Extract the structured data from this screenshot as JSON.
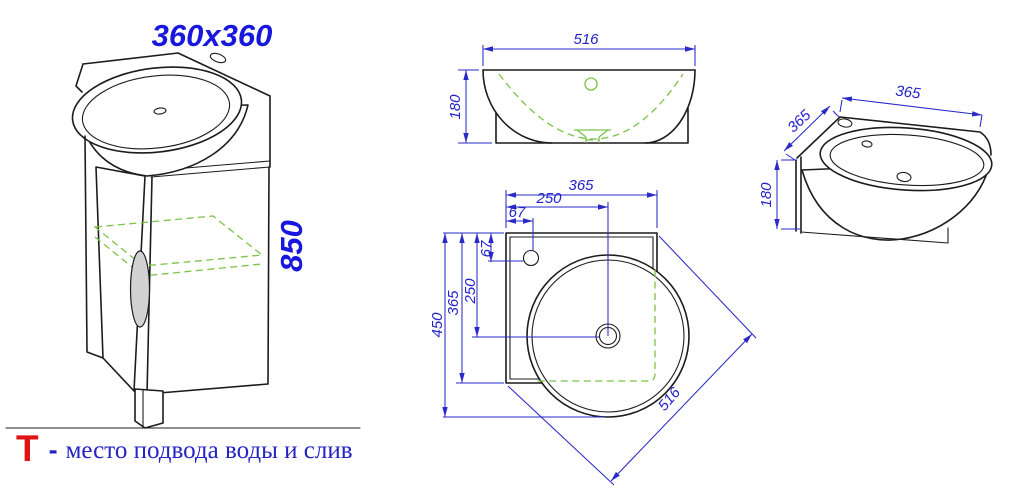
{
  "colors": {
    "dimension_blue": "#2a2ac8",
    "label_blue": "#2323cc",
    "big_label_blue": "#1717dd",
    "drawing_black": "#1c1c1c",
    "hidden_green": "#7cc247",
    "legend_red": "#e01414",
    "legend_blue": "#2424c4",
    "handle_gray": "#d2d2d2"
  },
  "views": {
    "perspective": {
      "size": "360x360",
      "height": "850"
    },
    "front": {
      "width": "516",
      "height": "180"
    },
    "side": {
      "width": "365",
      "depth": "365",
      "height": "180"
    },
    "plan": {
      "width": "365",
      "drain_x": "250",
      "faucet_x": "67",
      "faucet_y": "67",
      "drain_y": "250",
      "depth": "365",
      "total_depth": "450",
      "front_edge": "516"
    }
  },
  "legend": {
    "symbol": "Т",
    "dash": "-",
    "text": "место подвода воды и слив"
  }
}
